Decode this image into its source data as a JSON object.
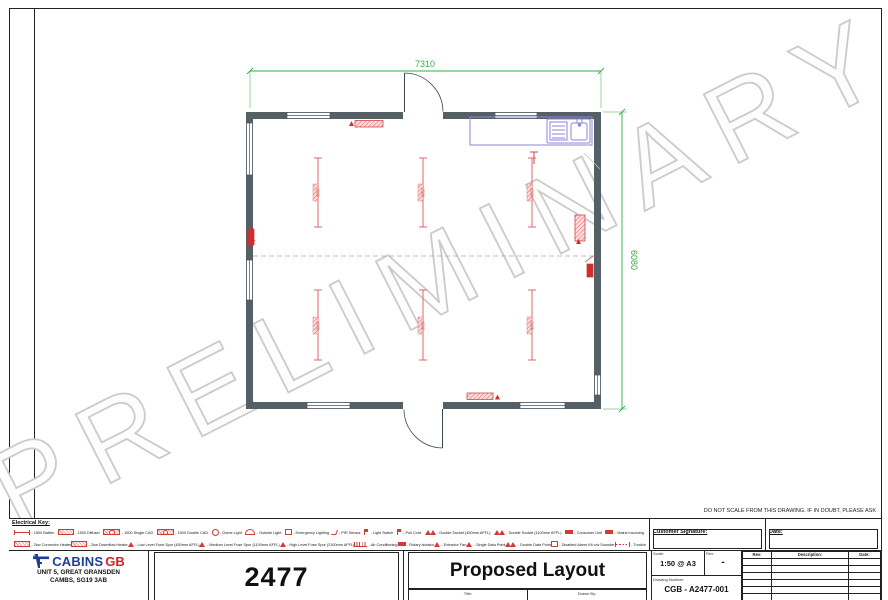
{
  "watermark": "PRELIMINARY",
  "notice": "DO NOT SCALE FROM THIS DRAWING. IF IN DOUBT, PLEASE ASK",
  "plan": {
    "width_dim": "7310",
    "height_dim": "6080",
    "light_label": "1500"
  },
  "electrical_key": {
    "title": "Electrical Key:",
    "row1": [
      {
        "symbol": "line",
        "label": "- 1500 Batten"
      },
      {
        "symbol": "hatch",
        "label": "- 1500 Diffuser"
      },
      {
        "symbol": "hatchc",
        "label": "- 1500 Single CAD"
      },
      {
        "symbol": "hatchc",
        "label": "- 1500 Double CAD"
      },
      {
        "symbol": "circle",
        "label": "- Dome Light"
      },
      {
        "symbol": "dome",
        "label": "- Outside Light"
      },
      {
        "symbol": "box",
        "label": "- Emergency Lighting"
      },
      {
        "symbol": "tick",
        "label": "- PIR Sensor"
      },
      {
        "symbol": "flag",
        "label": "- Light Switch"
      },
      {
        "symbol": "flag",
        "label": "- Pull Cord"
      },
      {
        "symbol": "tri2",
        "label": "- Double Socket (450mm AFFL)"
      },
      {
        "symbol": "tri2",
        "label": "- Double Socket (1100mm AFFL)"
      },
      {
        "symbol": "solid",
        "label": "- Consumer Unit"
      },
      {
        "symbol": "solid",
        "label": "- Mains Incoming"
      }
    ],
    "row2": [
      {
        "symbol": "hatch",
        "label": "- 2kw Convector Heater"
      },
      {
        "symbol": "hatch",
        "label": "- 2kw Downflow Heater"
      },
      {
        "symbol": "tri",
        "label": "- Low Level Fuse Spur (450mm AFFL)"
      },
      {
        "symbol": "tri",
        "label": "- Medium Level Fuse Spur (1100mm AFFL)"
      },
      {
        "symbol": "tri",
        "label": "- High Level Fuse Spur (2100mm AFFL)"
      },
      {
        "symbol": "comb",
        "label": "- Air Conditioning"
      },
      {
        "symbol": "solid",
        "label": "- Rotary Isolator"
      },
      {
        "symbol": "tri",
        "label": "- Extractor Fan"
      },
      {
        "symbol": "tri",
        "label": "- Single Data Point"
      },
      {
        "symbol": "tri2",
        "label": "- Double Data Point"
      },
      {
        "symbol": "box",
        "label": "- Disabled Alarm Kit c/w Sounder"
      },
      {
        "symbol": "bracket",
        "label": "- Trunking"
      }
    ]
  },
  "signature_block": {
    "customer_label": "Customer Signature:",
    "date_label": "Date:"
  },
  "title_block": {
    "logo_text_blue": "CABINS",
    "logo_text_red": "GB",
    "address_line1": "UNIT 5, GREAT GRANSDEN",
    "address_line2": "CAMBS, SG19 3AB",
    "job_number": "2477",
    "drawing_title": "Proposed Layout",
    "scale_label": "Scale:",
    "scale_value": "1:50 @ A3",
    "rev_label": "Rev:",
    "rev_value": "-",
    "drawing_number_label": "Drawing Number:",
    "drawing_number": "CGB - A2477-001",
    "strip_left_label": "Title:",
    "strip_right_label": "Drawn By:",
    "rev_table_headers": {
      "rev": "Rev:",
      "description": "Description:",
      "date": "Date:"
    },
    "rev_table_empty_rows": 6
  }
}
